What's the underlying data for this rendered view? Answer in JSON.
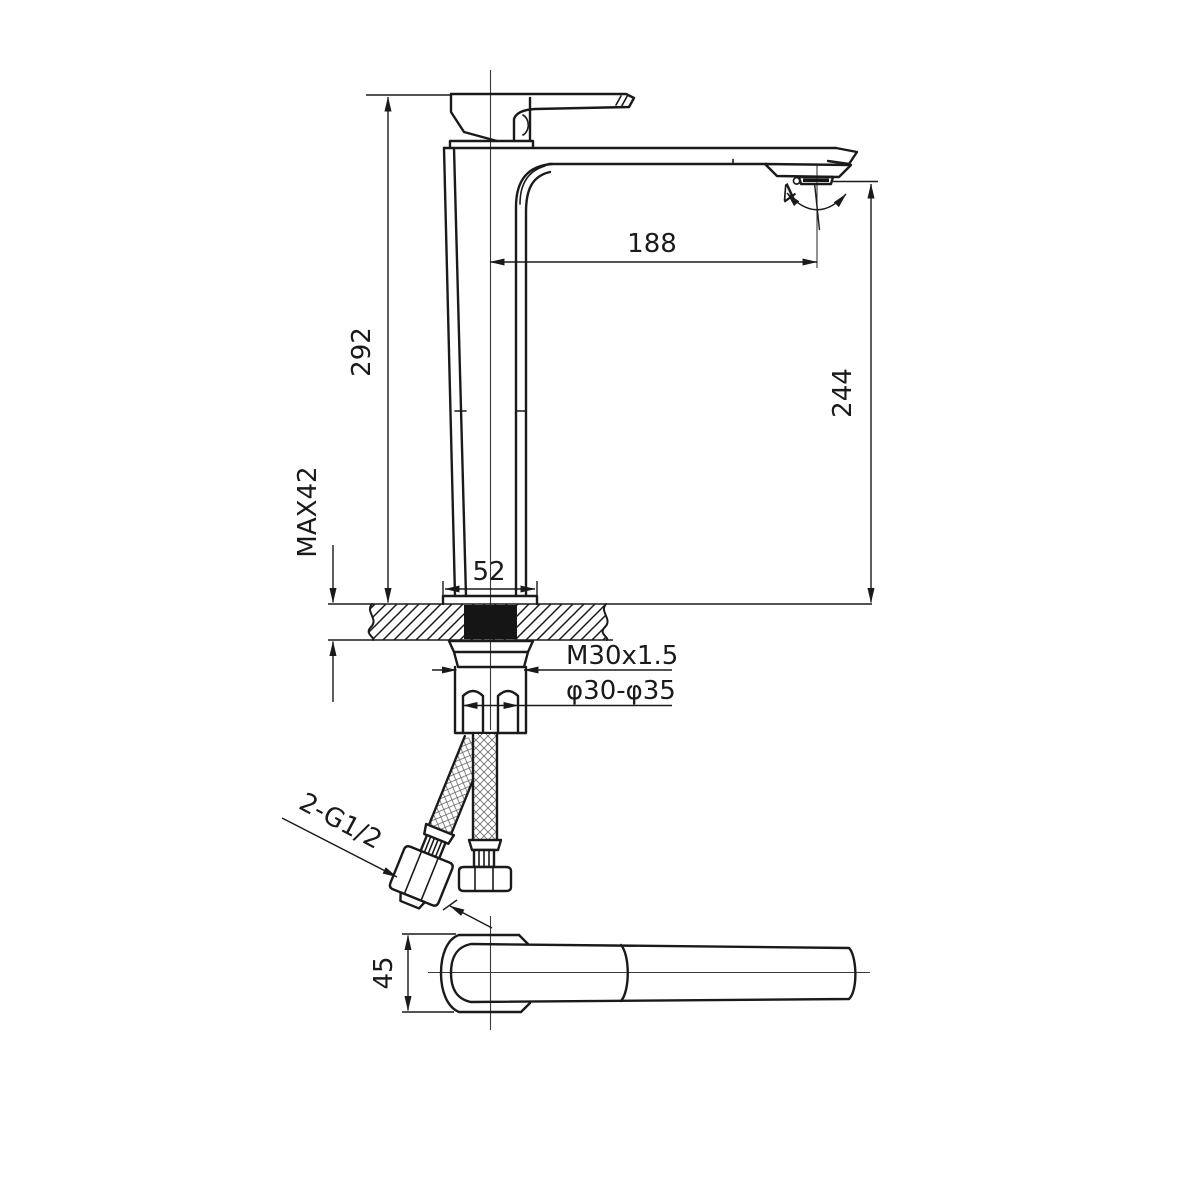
{
  "drawing": {
    "background": "#ffffff",
    "line_color": "#1a1a1a",
    "labels": {
      "overall_height": "292",
      "spout_reach": "188",
      "outlet_height": "244",
      "max_mounting_thickness": "MAX42",
      "base_width": "52",
      "shank_thread": "M30x1.5",
      "mounting_hole_diameter": "φ30-φ35",
      "hose_thread": "2-G1/2",
      "body_depth": "45",
      "spray_angle": "4°"
    }
  }
}
